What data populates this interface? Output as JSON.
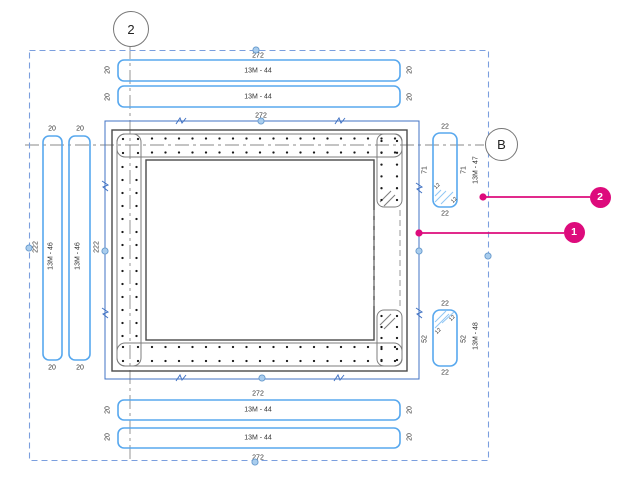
{
  "grid": {
    "column_label": "2",
    "row_label": "B"
  },
  "rebar_sets": {
    "top_bottom": {
      "tag": "13M - 44",
      "run_dim": "272",
      "end_dim": "20"
    },
    "left": {
      "tag": "13M - 46",
      "run_dim": "222",
      "end_dim": "20"
    },
    "right_upper": {
      "tag": "13M - 47",
      "end_dim": "22",
      "length_dim": "71",
      "hook_dim": "12"
    },
    "right_lower": {
      "tag": "13M - 48",
      "end_dim": "22",
      "length_dim": "52",
      "hook_dim": "12"
    }
  },
  "callouts": {
    "item_1": "1",
    "item_2": "2"
  },
  "colors": {
    "rebar_annotation_blue": "#58A8EE",
    "rebar_hatch_blue": "#90C6F4",
    "selection_dashed_blue": "#7B9FDE",
    "sketch_outline_blue": "#4273C4",
    "callout_magenta": "#DD0B7C"
  }
}
